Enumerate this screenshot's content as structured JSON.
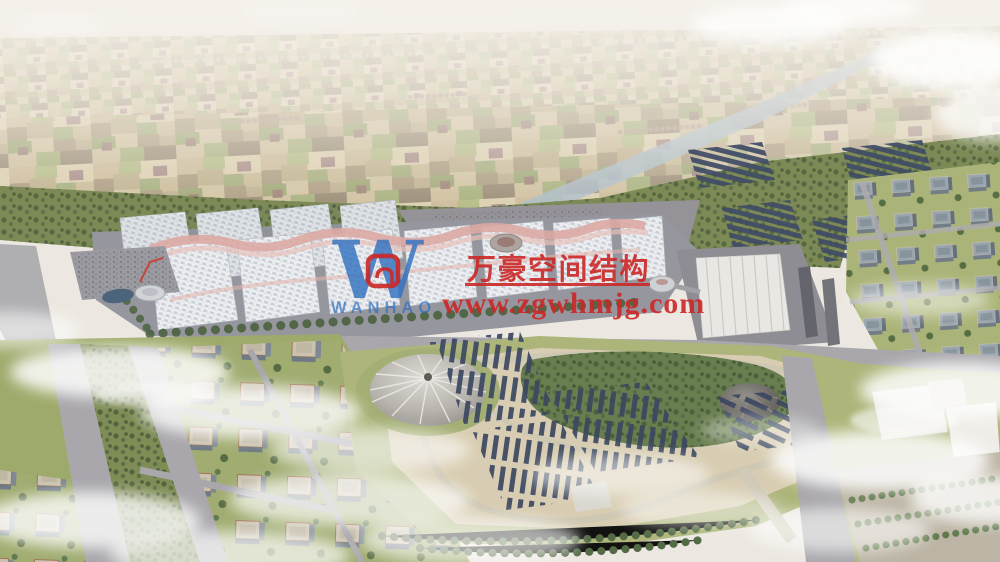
{
  "watermark": {
    "company_name": "万豪空间结构",
    "website": "www.zgwhmjg.com",
    "logo_letter": "W",
    "logo_subtext": "WANHAO",
    "red": "#c81818",
    "blue": "#2468bd"
  },
  "scene": {
    "palette": {
      "sky_haze": "#f0ebe4",
      "field_tan": "#d3c4a2",
      "greenbelt": "#75834c",
      "road_gray": "#a4a2a8",
      "hall_roof": "#eceef1",
      "ridge_pink": "#dca49e",
      "solar_navy": "#2e3b58",
      "park_tan": "#d7cbaf",
      "water": "#9db2c2"
    }
  }
}
